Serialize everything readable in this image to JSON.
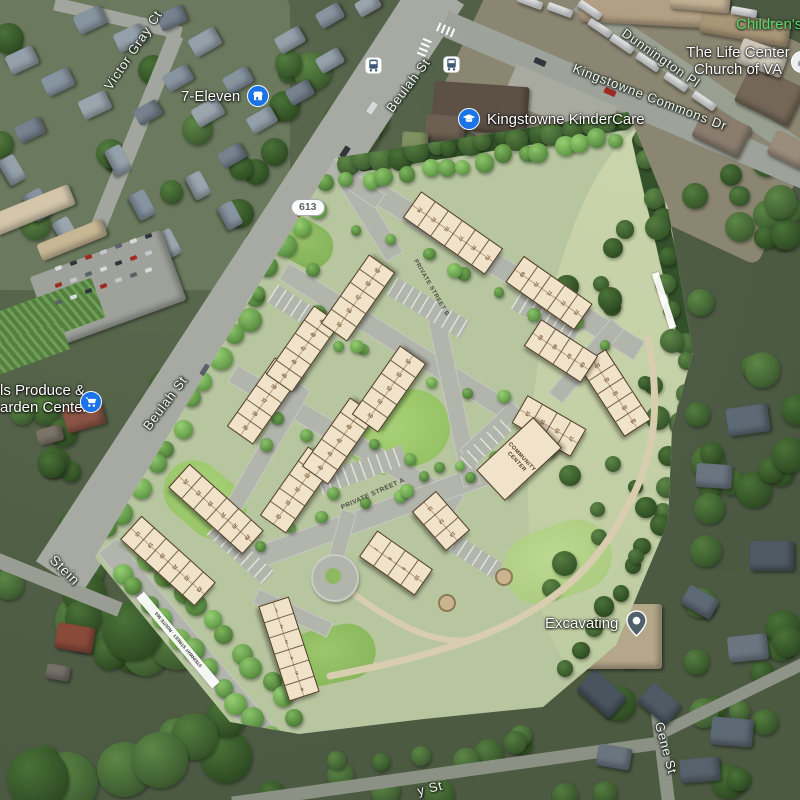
{
  "map": {
    "road_labels": {
      "victor_gray_ct": "Victor Gray Ct",
      "beulah_st_top": "Beulah St",
      "beulah_st_mid": "Beulah St",
      "kingstowne_commons_dr": "Kingstowne Commons Dr",
      "dunnington_pl": "Dunnington Pl",
      "gene_st": "Gene St",
      "y_st": "y St",
      "stein_fragment": "Stein"
    },
    "route_shield": "613",
    "pois": {
      "seven_eleven": {
        "label": "7-Eleven"
      },
      "kindercare": {
        "label": "Kingstowne KinderCare"
      },
      "produce_garden": {
        "line1": "ls Produce &",
        "line2": "arden Center"
      },
      "excavating": {
        "label": "Excavating"
      },
      "childrens": {
        "label": "Children's"
      },
      "life_center": {
        "line1": "The Life Center",
        "line2": "Church of VA"
      }
    },
    "colors": {
      "poi_blue": "#1a73e8",
      "green_label": "#54dd68",
      "pin_gray": "#50616b",
      "bus_glyph": "#3c5a75"
    }
  },
  "site_plan": {
    "street_a": "PRIVATE STREET A",
    "street_b": "PRIVATE STREET B",
    "community_center": [
      "COMMUNITY",
      "CENTER"
    ],
    "steinway_strip": "STEINWAY STREET - ROUTE 963",
    "buildings": [
      {
        "units": [
          "1",
          "2",
          "3",
          "4",
          "5",
          "6"
        ]
      },
      {
        "units": [
          "7",
          "8",
          "9",
          "10"
        ]
      },
      {
        "units": [
          "11",
          "12",
          "13"
        ]
      },
      {
        "units": [
          "14",
          "15",
          "16",
          "17"
        ]
      },
      {
        "units": [
          "18",
          "19",
          "20",
          "21",
          "22",
          "23"
        ]
      },
      {
        "units": [
          "24",
          "25",
          "26",
          "27",
          "28",
          "29"
        ]
      },
      {
        "units": [
          "30",
          "31",
          "32",
          "33",
          "34"
        ]
      },
      {
        "units": [
          "35",
          "36",
          "37",
          "38",
          "39"
        ]
      },
      {
        "units": [
          "40",
          "41",
          "42",
          "43",
          "44"
        ]
      },
      {
        "units": [
          "45",
          "46",
          "47",
          "48",
          "49"
        ]
      },
      {
        "units": [
          "50",
          "51",
          "52",
          "53",
          "54"
        ]
      },
      {
        "units": [
          "55",
          "56",
          "57",
          "58",
          "59"
        ]
      },
      {
        "units": [
          "60",
          "61",
          "62",
          "63",
          "64"
        ]
      },
      {
        "units": [
          "65",
          "66",
          "67",
          "68"
        ]
      },
      {
        "units": [
          "69",
          "70",
          "71",
          "72",
          "73"
        ]
      },
      {
        "units": [
          "74",
          "75",
          "76",
          "77",
          "78",
          "79"
        ]
      }
    ]
  }
}
